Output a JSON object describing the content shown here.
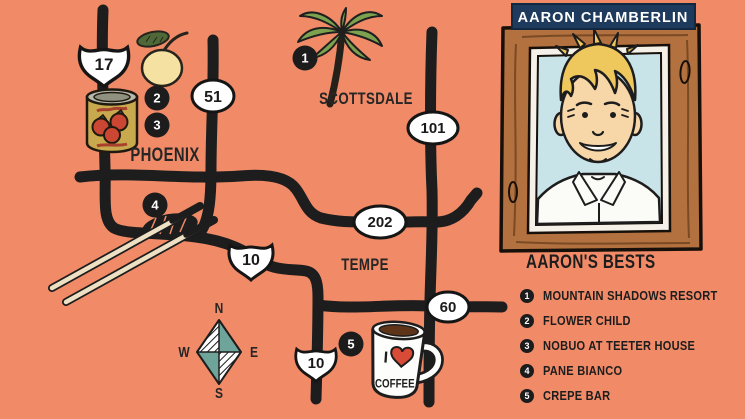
{
  "colors": {
    "bg": "#F08A67",
    "road": "#1D1D1D",
    "ink": "#262626",
    "shield": "#FFFFFF",
    "banner-navy": "#1E3A5C",
    "banner-text": "#FFFFFF",
    "teal": "#6FA49A",
    "heart-red": "#D94B36",
    "wood": "#B3713F",
    "photo-blue": "#C9E4E9",
    "hair-blond": "#EEC85D"
  },
  "map": {
    "city_labels": {
      "phoenix": "PHOENIX",
      "scottsdale": "SCOTTSDALE",
      "tempe": "TEMPE"
    },
    "shields": {
      "i17": "17",
      "sr51": "51",
      "loop101": "101",
      "loop202": "202",
      "i10_upper": "10",
      "i10_lower": "10",
      "us60": "60"
    },
    "markers": {
      "m1": "1",
      "m2": "2",
      "m3": "3",
      "m4": "4",
      "m5": "5"
    },
    "compass": {
      "n": "N",
      "s": "S",
      "e": "E",
      "w": "W"
    },
    "mug_text": {
      "word1": "I",
      "word2": "COFFEE"
    },
    "icons": [
      "palm-tree-icon",
      "lemon-icon",
      "tomato-can-icon",
      "chopsticks-icon",
      "coffee-mug-icon",
      "compass-rose-icon",
      "coffee-heart-icon",
      "portrait-photo"
    ]
  },
  "panel": {
    "name_banner": "AARON CHAMBERLIN",
    "list_title": "AARON'S BESTS",
    "items": [
      {
        "num": "1",
        "label": "MOUNTAIN SHADOWS RESORT"
      },
      {
        "num": "2",
        "label": "FLOWER CHILD"
      },
      {
        "num": "3",
        "label": "NOBUO AT TEETER HOUSE"
      },
      {
        "num": "4",
        "label": "PANE BIANCO"
      },
      {
        "num": "5",
        "label": "CREPE BAR"
      }
    ]
  }
}
